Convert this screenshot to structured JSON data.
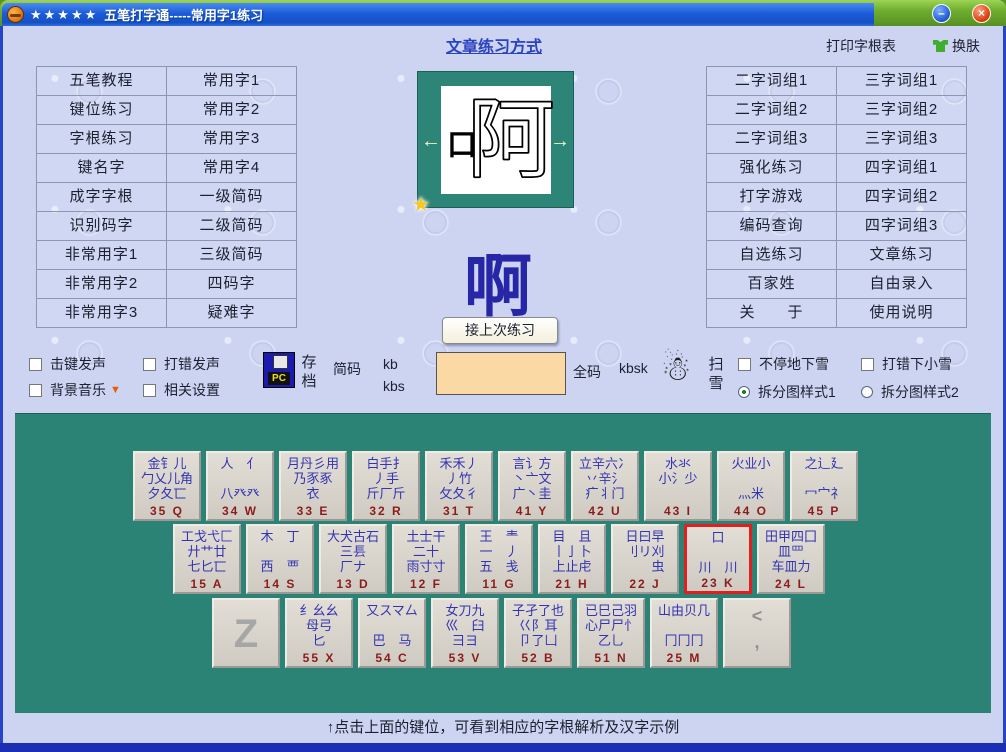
{
  "window": {
    "stars": "★★★★★",
    "title": "五笔打字通-----常用字1练习",
    "minimize": "–",
    "close": "×"
  },
  "topbar": {
    "article_link": "文章练习方式",
    "print_label": "打印字根表",
    "skin_label": "换肤"
  },
  "left_menu": {
    "col1": [
      "五笔教程",
      "键位练习",
      "字根练习",
      "键名字",
      "成字字根",
      "识别码字",
      "非常用字1",
      "非常用字2",
      "非常用字3"
    ],
    "col2": [
      "常用字1",
      "常用字2",
      "常用字3",
      "常用字4",
      "一级简码",
      "二级简码",
      "三级简码",
      "四码字",
      "疑难字"
    ]
  },
  "right_menu": {
    "col1": [
      "二字词组1",
      "二字词组2",
      "二字词组3",
      "强化练习",
      "打字游戏",
      "编码查询",
      "自选练习",
      "百家姓",
      "关　　于"
    ],
    "col2": [
      "三字词组1",
      "三字词组2",
      "三字词组3",
      "四字词组1",
      "四字词组2",
      "四字词组3",
      "文章练习",
      "自由录入",
      "使用说明"
    ]
  },
  "practice": {
    "char_left_part": "口",
    "char_right_part": "阿",
    "current_char": "啊",
    "left_arrow": "←",
    "right_arrow": "→",
    "star": "★",
    "resume_button": "接上次练习",
    "jianma_label": "简码",
    "jianma_code1": "kb",
    "jianma_code2": "kbs",
    "input_value": "",
    "quanma_label": "全码",
    "quanma_code": "kbsk",
    "snowman": "☃"
  },
  "controls": {
    "cb_keysound": "击键发声",
    "cb_errsound": "打错发声",
    "cb_bgmusic": "背景音乐",
    "cb_settings": "相关设置",
    "dropdown_arrow": "▼",
    "save_label_1": "存",
    "save_label_2": "档",
    "sweep_label_1": "扫",
    "sweep_label_2": "雪",
    "cb_snow": "不停地下雪",
    "cb_errsnow": "打错下小雪",
    "radio_style1": "拆分图样式1",
    "radio_style2": "拆分图样式2",
    "selected_radio": "拆分图样式1"
  },
  "keyboard": {
    "hint": "↑点击上面的键位，可看到相应的字根解析及汉字示例",
    "rows": [
      {
        "offset": 118,
        "keys": [
          {
            "label": "35 Q",
            "lines": [
              "金钅儿",
              "勹乂儿角",
              "夕夂匸"
            ]
          },
          {
            "label": "34 W",
            "lines": [
              "人　亻",
              "",
              "八癶癶"
            ]
          },
          {
            "label": "33 E",
            "lines": [
              "月丹彡用",
              "乃豕豖",
              "衣"
            ]
          },
          {
            "label": "32 R",
            "lines": [
              "白手扌",
              "丿手",
              "斤厂斤"
            ]
          },
          {
            "label": "31 T",
            "lines": [
              "禾禾丿",
              "丿竹",
              "攵夂彳"
            ]
          },
          {
            "label": "41 Y",
            "lines": [
              "言讠方",
              "丶亠文",
              "广丶圭"
            ]
          },
          {
            "label": "42 U",
            "lines": [
              "立辛六冫",
              "丷辛氵",
              "疒丬门"
            ]
          },
          {
            "label": "43 I",
            "lines": [
              "水氺",
              "小氵少",
              ""
            ]
          },
          {
            "label": "44 O",
            "lines": [
              "火业小",
              "",
              "灬米"
            ]
          },
          {
            "label": "45 P",
            "lines": [
              "之辶廴",
              "",
              "冖宀礻"
            ]
          }
        ]
      },
      {
        "offset": 158,
        "keys": [
          {
            "label": "15 A",
            "lines": [
              "工戈弋匚",
              "廾艹廿",
              "七匕匸"
            ]
          },
          {
            "label": "14 S",
            "lines": [
              "木　丁",
              "",
              "西　覀"
            ]
          },
          {
            "label": "13 D",
            "lines": [
              "大犬古石",
              "三镸",
              "厂ナ"
            ]
          },
          {
            "label": "12 F",
            "lines": [
              "土士干",
              "二十",
              "雨寸寸"
            ]
          },
          {
            "label": "11 G",
            "lines": [
              "王　龶",
              "一　丿",
              "五　戋"
            ]
          },
          {
            "label": "21 H",
            "lines": [
              "目　且",
              "丨亅卜",
              "上止虍"
            ]
          },
          {
            "label": "22 J",
            "lines": [
              "日曰早",
              "刂リ刈",
              "　　虫"
            ]
          },
          {
            "label": "23 K",
            "lines": [
              "口",
              "",
              "川　川"
            ],
            "active": true
          },
          {
            "label": "24 L",
            "lines": [
              "田甲四囗",
              "皿罒",
              "车皿力"
            ]
          }
        ]
      },
      {
        "offset": 197,
        "keys": [
          {
            "label": "",
            "letter": "Z",
            "lines": []
          },
          {
            "label": "55 X",
            "lines": [
              "纟幺幺",
              "母弓",
              "匕"
            ]
          },
          {
            "label": "54 C",
            "lines": [
              "又スマ厶",
              "",
              "巴　马"
            ]
          },
          {
            "label": "53 V",
            "lines": [
              "女刀九",
              "巛　臼",
              "彐ヨ"
            ]
          },
          {
            "label": "52 B",
            "lines": [
              "子孑了也",
              "巜阝耳",
              "卩了凵"
            ]
          },
          {
            "label": "51 N",
            "lines": [
              "已巳己羽",
              "心尸尸忄",
              "乙乚"
            ]
          },
          {
            "label": "25 M",
            "lines": [
              "山由贝几",
              "",
              "冂冂冂"
            ]
          },
          {
            "label": "",
            "punct1": "<",
            "punct2": ",",
            "lines": []
          }
        ]
      }
    ]
  }
}
